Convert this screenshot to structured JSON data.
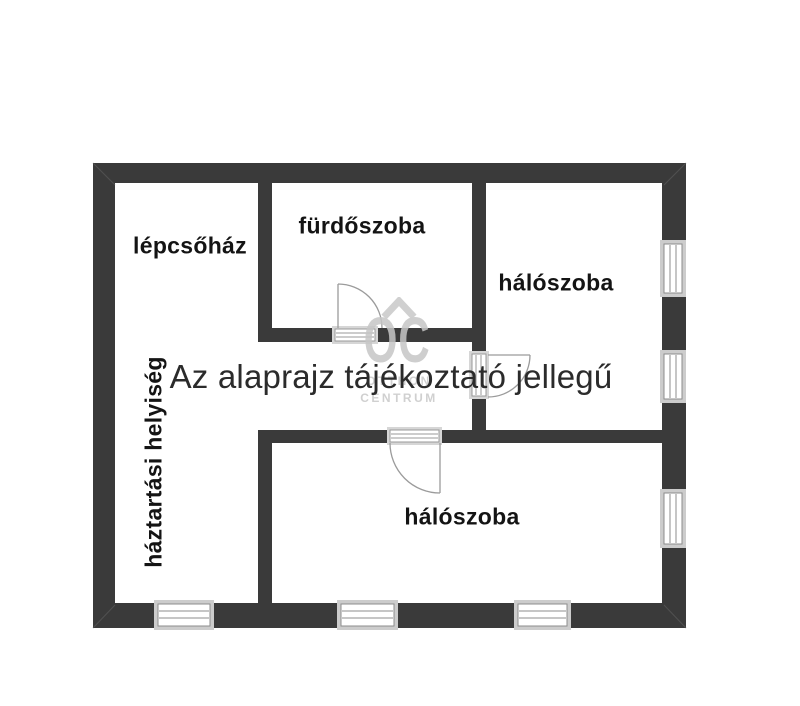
{
  "floor_plan": {
    "disclaimer": "Az alaprajz tájékoztató jellegű",
    "rooms": [
      {
        "label": "lépcsőház"
      },
      {
        "label": "fürdőszoba"
      },
      {
        "label": "hálószoba"
      },
      {
        "label": "hálószoba"
      },
      {
        "label": "háztartási helyiség"
      }
    ],
    "watermark": {
      "initials": "OC",
      "word_top": "OTTHON",
      "word_bottom": "CENTRUM"
    },
    "colors": {
      "wall": "#3a3a3a",
      "window_frame": "#cccccc",
      "detail_line": "#8c8c8c",
      "door_line": "#9b9b9b",
      "label_text": "#141414",
      "title_text": "#2b2b2b",
      "watermark": "#c8c8c8"
    }
  }
}
